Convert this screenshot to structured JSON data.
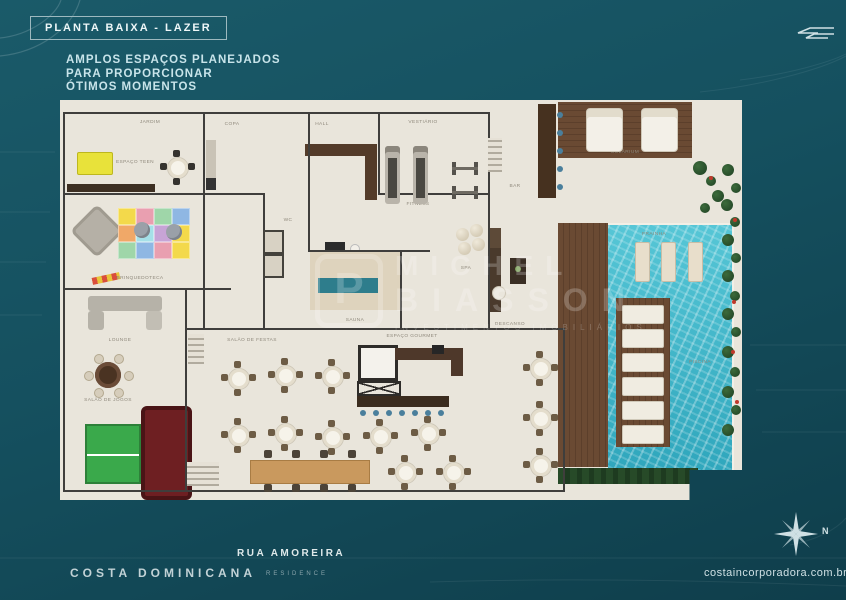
{
  "header": {
    "title": "PLANTA BAIXA - LAZER",
    "tagline": "AMPLOS ESPAÇOS PLANEJADOS\nPARA PROPORCIONAR\nÓTIMOS MOMENTOS"
  },
  "footer": {
    "street": "RUA AMOREIRA",
    "brand": "COSTA DOMINICANA",
    "brand_suffix": "RESIDENCE",
    "website": "costaincorporadora.com.br",
    "compass_label": "N"
  },
  "watermark": {
    "monogram": "P",
    "line1": "MICHEL",
    "line2": "BIASSON",
    "tagline": "INVESTIMENTOS IMOBILIÁRIOS"
  },
  "colors": {
    "background_teal": "#15505f",
    "floor_beige": "#e9e5db",
    "pool_water": "#3fb4c8",
    "deck_wood": "#6a4a33",
    "wall": "#3f3e3c",
    "accent_text": "#c8e4ea"
  },
  "plan": {
    "labels": [
      {
        "text": "JARDIM",
        "x": 90,
        "y": 22
      },
      {
        "text": "ESPAÇO TEEN",
        "x": 75,
        "y": 62
      },
      {
        "text": "BRINQUEDOTECA",
        "x": 80,
        "y": 178
      },
      {
        "text": "LOUNGE",
        "x": 60,
        "y": 240
      },
      {
        "text": "SALÃO DE JOGOS",
        "x": 48,
        "y": 300
      },
      {
        "text": "HALL",
        "x": 262,
        "y": 24
      },
      {
        "text": "COPA",
        "x": 172,
        "y": 24
      },
      {
        "text": "WC",
        "x": 228,
        "y": 120
      },
      {
        "text": "VESTIÁRIO",
        "x": 363,
        "y": 22
      },
      {
        "text": "FITNESS",
        "x": 358,
        "y": 104
      },
      {
        "text": "SAUNA",
        "x": 295,
        "y": 220
      },
      {
        "text": "SPA",
        "x": 406,
        "y": 168
      },
      {
        "text": "DESCANSO",
        "x": 450,
        "y": 224
      },
      {
        "text": "BAR",
        "x": 455,
        "y": 86
      },
      {
        "text": "SALÃO DE FESTAS",
        "x": 192,
        "y": 240
      },
      {
        "text": "ESPAÇO GOURMET",
        "x": 352,
        "y": 236
      },
      {
        "text": "SOLÁRIUM",
        "x": 565,
        "y": 52
      },
      {
        "text": "PRAINHA",
        "x": 594,
        "y": 134
      },
      {
        "text": "PISCINA",
        "x": 640,
        "y": 262
      }
    ],
    "walls": [
      [
        3,
        12,
        426,
        2
      ],
      [
        3,
        93,
        140,
        2
      ],
      [
        3,
        188,
        168,
        2
      ],
      [
        125,
        228,
        380,
        2
      ],
      [
        3,
        390,
        502,
        2
      ],
      [
        320,
        93,
        110,
        2
      ],
      [
        250,
        150,
        120,
        2
      ],
      [
        143,
        93,
        62,
        2
      ],
      [
        3,
        12,
        2,
        380
      ],
      [
        143,
        12,
        2,
        218
      ],
      [
        248,
        12,
        2,
        140
      ],
      [
        318,
        12,
        2,
        83
      ],
      [
        428,
        12,
        2,
        218
      ],
      [
        503,
        228,
        2,
        164
      ],
      [
        125,
        188,
        2,
        204
      ],
      [
        340,
        150,
        2,
        80
      ],
      [
        203,
        93,
        2,
        137
      ]
    ],
    "party_tables": [
      [
        178,
        278
      ],
      [
        225,
        275
      ],
      [
        272,
        276
      ],
      [
        178,
        335
      ],
      [
        225,
        333
      ],
      [
        272,
        337
      ],
      [
        320,
        336
      ],
      [
        368,
        333
      ],
      [
        345,
        372
      ],
      [
        393,
        372
      ],
      [
        480,
        268
      ],
      [
        480,
        318
      ],
      [
        480,
        365
      ]
    ],
    "teen_table": {
      "x": 117,
      "y": 67
    },
    "poker_table": {
      "x": 48,
      "y": 275
    },
    "long_table_chairs_x": [
      14,
      42,
      70,
      98
    ],
    "deck_loungers_y": [
      205,
      229,
      253,
      277,
      301,
      325
    ],
    "pool_loungers_x": [
      575,
      601,
      628
    ],
    "daybeds_x": [
      526,
      581
    ],
    "bar_stools_festas": {
      "count": 7,
      "x0": 300,
      "dx": 13,
      "y": 310
    },
    "bar_stools_pool": {
      "count": 5,
      "x": 497,
      "y0": 12,
      "dy": 18
    },
    "poufs": [
      [
        74,
        122
      ],
      [
        106,
        124
      ]
    ],
    "spheres": [
      [
        396,
        128
      ],
      [
        410,
        124
      ],
      [
        398,
        142
      ],
      [
        412,
        138
      ]
    ],
    "mat_colors": [
      "#f3d94b",
      "#e99fb0",
      "#9fd6a9",
      "#8fb7e3",
      "#f0a868",
      "#a5e0e8",
      "#c7a4d6",
      "#f3d94b",
      "#9fd6a9",
      "#8fb7e3",
      "#e99fb0",
      "#f3d94b"
    ],
    "stairs": [
      [
        428,
        38,
        14,
        34
      ],
      [
        128,
        234,
        16,
        30
      ],
      [
        127,
        362,
        32,
        24
      ]
    ],
    "elevators": [
      [
        203,
        130
      ],
      [
        203,
        154
      ]
    ],
    "treadmills_x": [
      325,
      353
    ],
    "gym_machines_y": [
      62,
      86
    ],
    "plants": [
      [
        668,
        70,
        6
      ],
      [
        676,
        88,
        5
      ],
      [
        667,
        105,
        6
      ],
      [
        675,
        122,
        5
      ],
      [
        668,
        140,
        6
      ],
      [
        676,
        158,
        5
      ],
      [
        668,
        176,
        6
      ],
      [
        675,
        196,
        5
      ],
      [
        668,
        214,
        6
      ],
      [
        676,
        232,
        5
      ],
      [
        668,
        252,
        6
      ],
      [
        675,
        272,
        5
      ],
      [
        668,
        292,
        6
      ],
      [
        676,
        310,
        5
      ],
      [
        668,
        330,
        6
      ],
      [
        640,
        68,
        7
      ],
      [
        651,
        81,
        5
      ],
      [
        658,
        96,
        6
      ],
      [
        645,
        108,
        5
      ]
    ],
    "flowers": [
      [
        673,
        118
      ],
      [
        671,
        250
      ],
      [
        675,
        300
      ],
      [
        649,
        76
      ],
      [
        672,
        200
      ]
    ]
  }
}
